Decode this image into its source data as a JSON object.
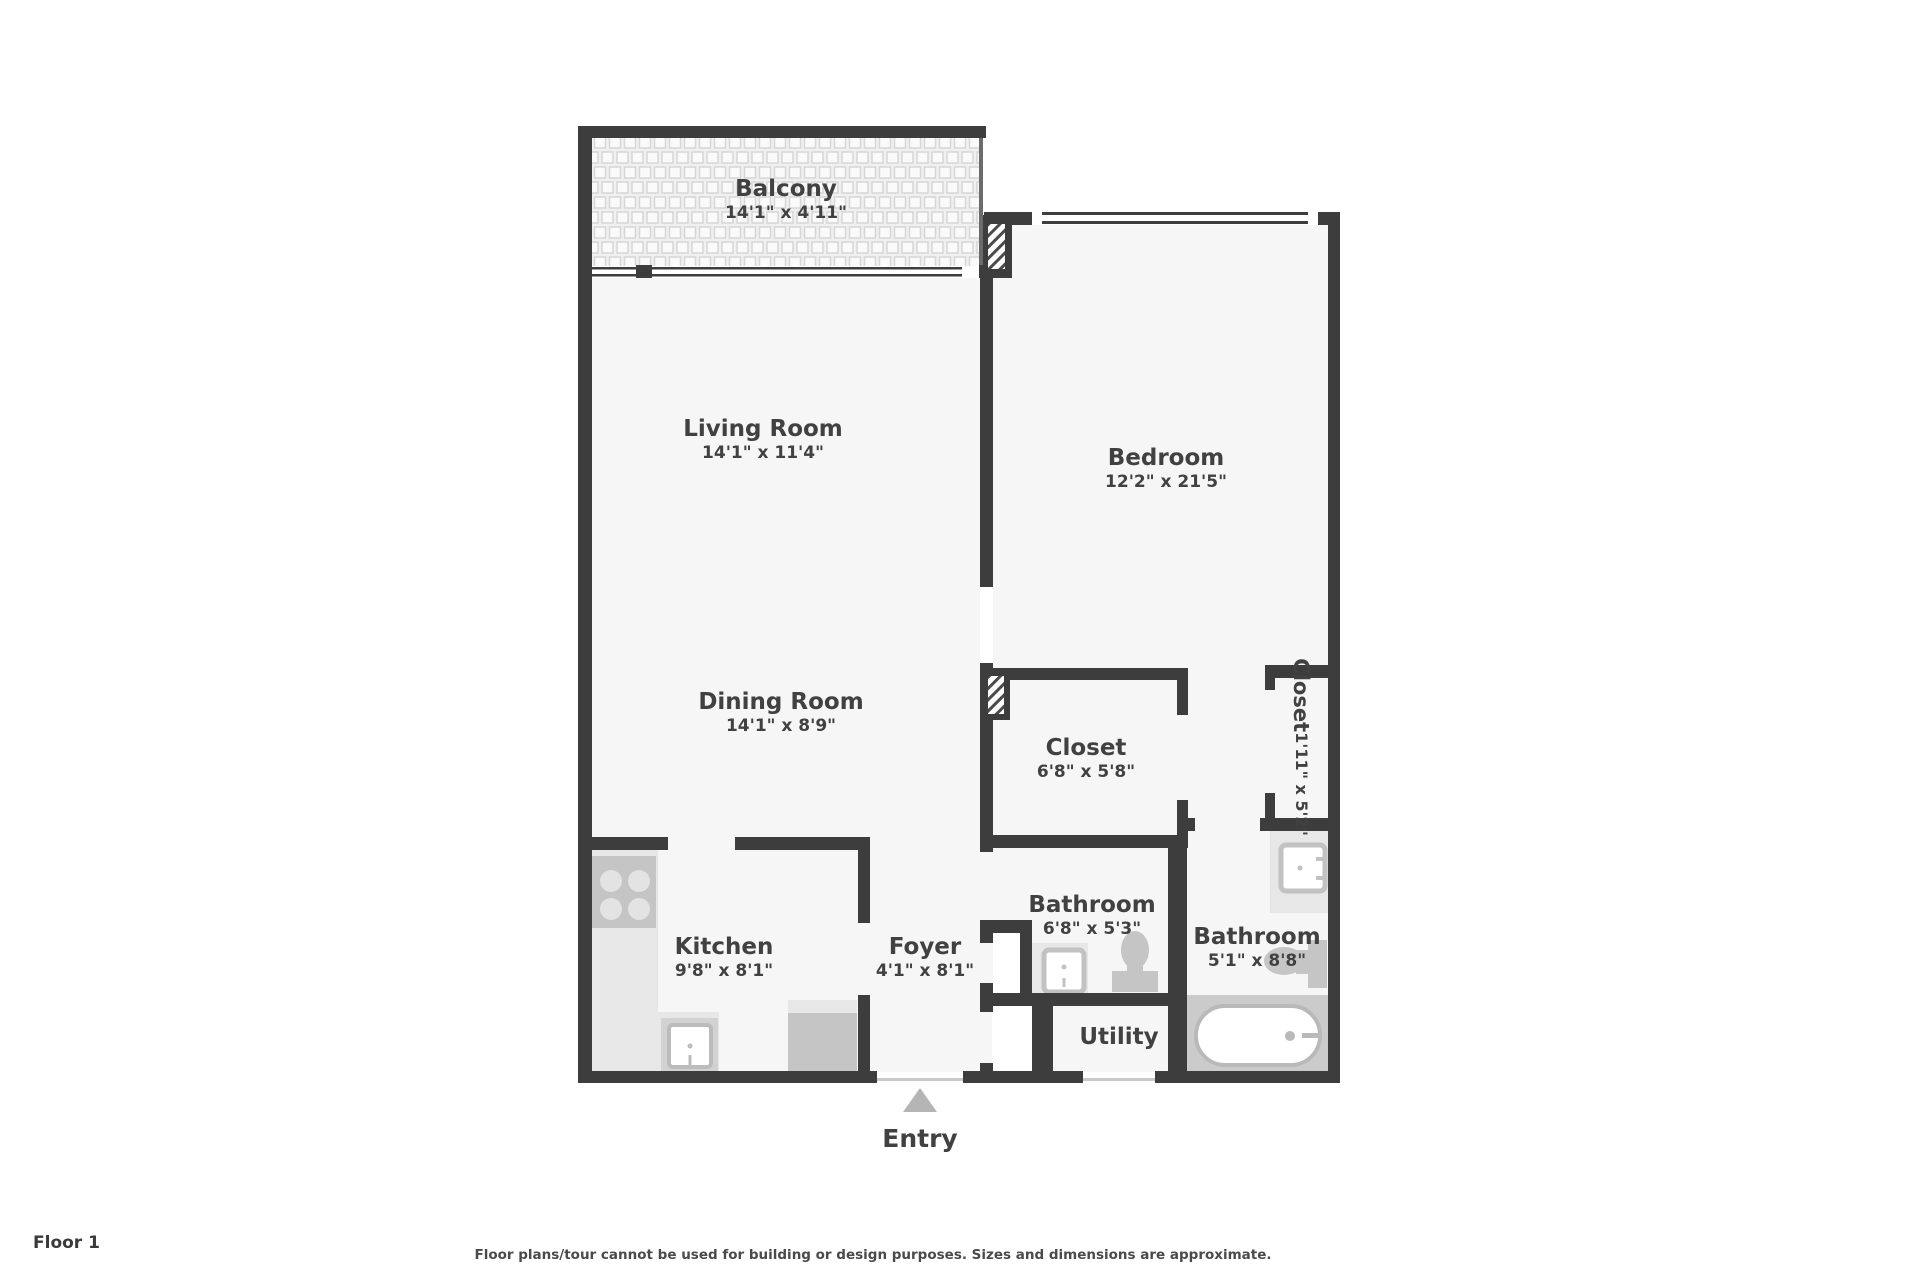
{
  "title": "Floor plan",
  "floor_label": "Floor 1",
  "disclaimer": "Floor plans/tour cannot be used for building or design purposes. Sizes and dimensions are approximate.",
  "entry": {
    "label": "Entry",
    "marker": "up-triangle"
  },
  "rooms": {
    "balcony": {
      "name": "Balcony",
      "dims": "14'1\" x 4'11\""
    },
    "living_room": {
      "name": "Living Room",
      "dims": "14'1\" x 11'4\""
    },
    "bedroom": {
      "name": "Bedroom",
      "dims": "12'2\" x 21'5\""
    },
    "dining_room": {
      "name": "Dining Room",
      "dims": "14'1\" x 8'9\""
    },
    "closet": {
      "name": "Closet",
      "dims": "6'8\" x 5'8\""
    },
    "closet_small": {
      "name": "Closet",
      "dims": "1'11\" x 5'2\""
    },
    "kitchen": {
      "name": "Kitchen",
      "dims": "9'8\" x 8'1\""
    },
    "foyer": {
      "name": "Foyer",
      "dims": "4'1\" x 8'1\""
    },
    "bathroom_1": {
      "name": "Bathroom",
      "dims": "6'8\" x 5'3\""
    },
    "bathroom_2": {
      "name": "Bathroom",
      "dims": "5'1\" x 8'8\""
    },
    "utility": {
      "name": "Utility"
    }
  },
  "fixtures": [
    "stove-icon",
    "kitchen-sink-icon",
    "dishwasher-icon",
    "toilet-icon",
    "toilet-icon",
    "bathroom-sink-icon",
    "bathroom-sink-icon",
    "bathtub-icon"
  ],
  "colors": {
    "wall": "#3d3d3d",
    "floor": "#f6f6f6",
    "fixture_light": "#e7e7e7",
    "fixture_mid": "#c5c5c5",
    "floor_shade": "#cbcbcb",
    "text": "#414141",
    "window_line": "#3d3d3d",
    "door_line": "#c9c9c9",
    "entry_arrow": "#b5b5b5"
  }
}
